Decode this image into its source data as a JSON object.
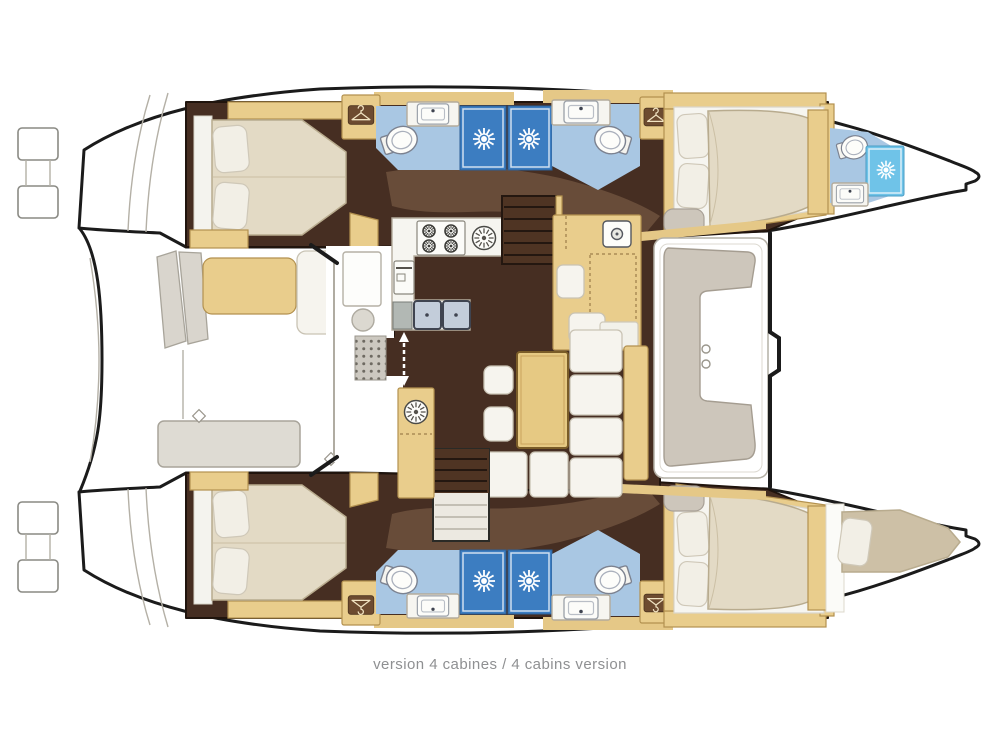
{
  "caption": {
    "text": "version 4 cabines / 4 cabins version"
  },
  "palette": {
    "hull-line": "#1b1b1b",
    "floor-dark": "#462e22",
    "floor-swath": "#8a6a50",
    "wood-tan": "#e9cd8c",
    "wood-stroke": "#b3914f",
    "deck-tan": "#e5c887",
    "wood-dark": "#6d4b30",
    "mattress": "#e3dac5",
    "berth-mattress": "#cdc0a6",
    "mattress-stroke": "#b8ab8e",
    "pillow": "#f2efe6",
    "bath-floor": "#a9c7e3",
    "shower-blue": "#3c7dc1",
    "shower-cyan": "#6fc3e8",
    "basin-blue": "#c3cdda",
    "counter-white": "#f6f5f0",
    "furn-gray": "#d9d5cd",
    "seat-gray": "#cdc6bb",
    "table-gray": "#dedbd3",
    "table-tan": "#e6c983",
    "cushion-white": "#f6f4ee",
    "line-gray": "#b4b0a6",
    "caption-gray": "#8f9092"
  },
  "icons": {
    "shower-head-icon": "white sunburst on blue shower stall",
    "toilet-icon": "tilted oval bowl with tank",
    "washbasin-icon": "rounded rectangle basin with tap dot",
    "clothes-hanger-icon": "hanger glyph in brown box",
    "stove-burner-icon": "circle with radial spokes (x4)",
    "round-sink-icon": "spoked circle on counter",
    "oven-icon": "small appliance front with handle",
    "sliding-door-arrow-icon": "white dashed double-headed arrow",
    "swim-step-icon": "transom step rectangles",
    "stairs-icon": "parallel tread lines"
  }
}
